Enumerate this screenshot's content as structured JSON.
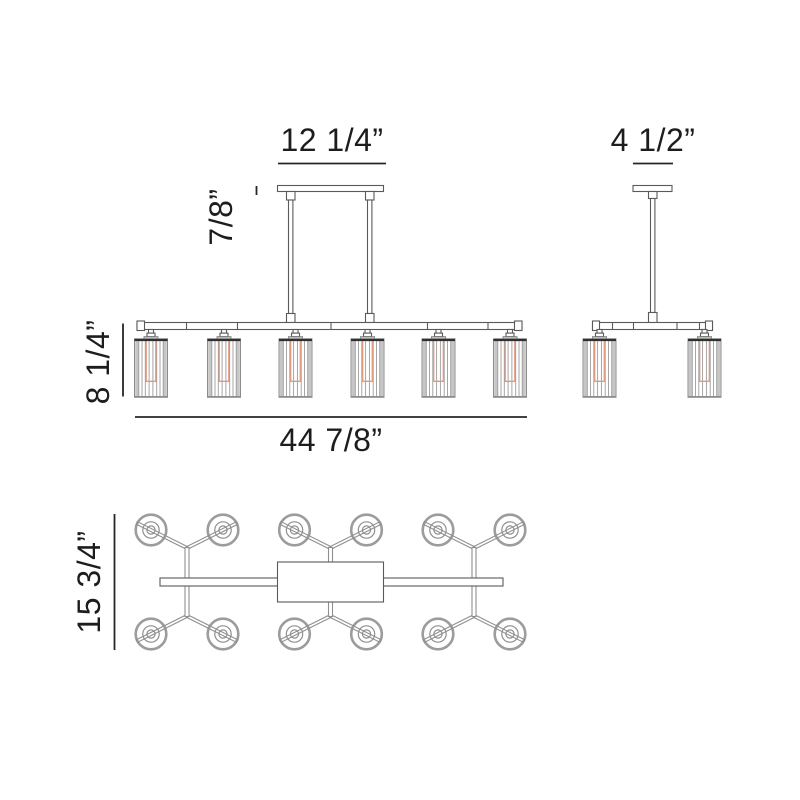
{
  "title": "linear chandelier dimension drawing",
  "labels": {
    "front_canopy_width": "12 1/4”",
    "front_canopy_height": "7/8”",
    "front_fixture_height": "8 1/4”",
    "front_overall_width": "44 7/8”",
    "side_width": "4 1/2”",
    "plan_depth": "15 3/4”"
  },
  "views": {
    "front_shade_count": 6,
    "side_shade_count": 2,
    "plan_shade_count": 12
  },
  "colors": {
    "dimension_line": "#262626",
    "text": "#1d1d1d",
    "fixture_line": "#5a5a5a",
    "shade_line": "#9c9c9c",
    "shade_band": "#c6c6c6",
    "shade_top": "#303030",
    "bulb_orange": "#e2987a",
    "background": "#ffffff"
  }
}
